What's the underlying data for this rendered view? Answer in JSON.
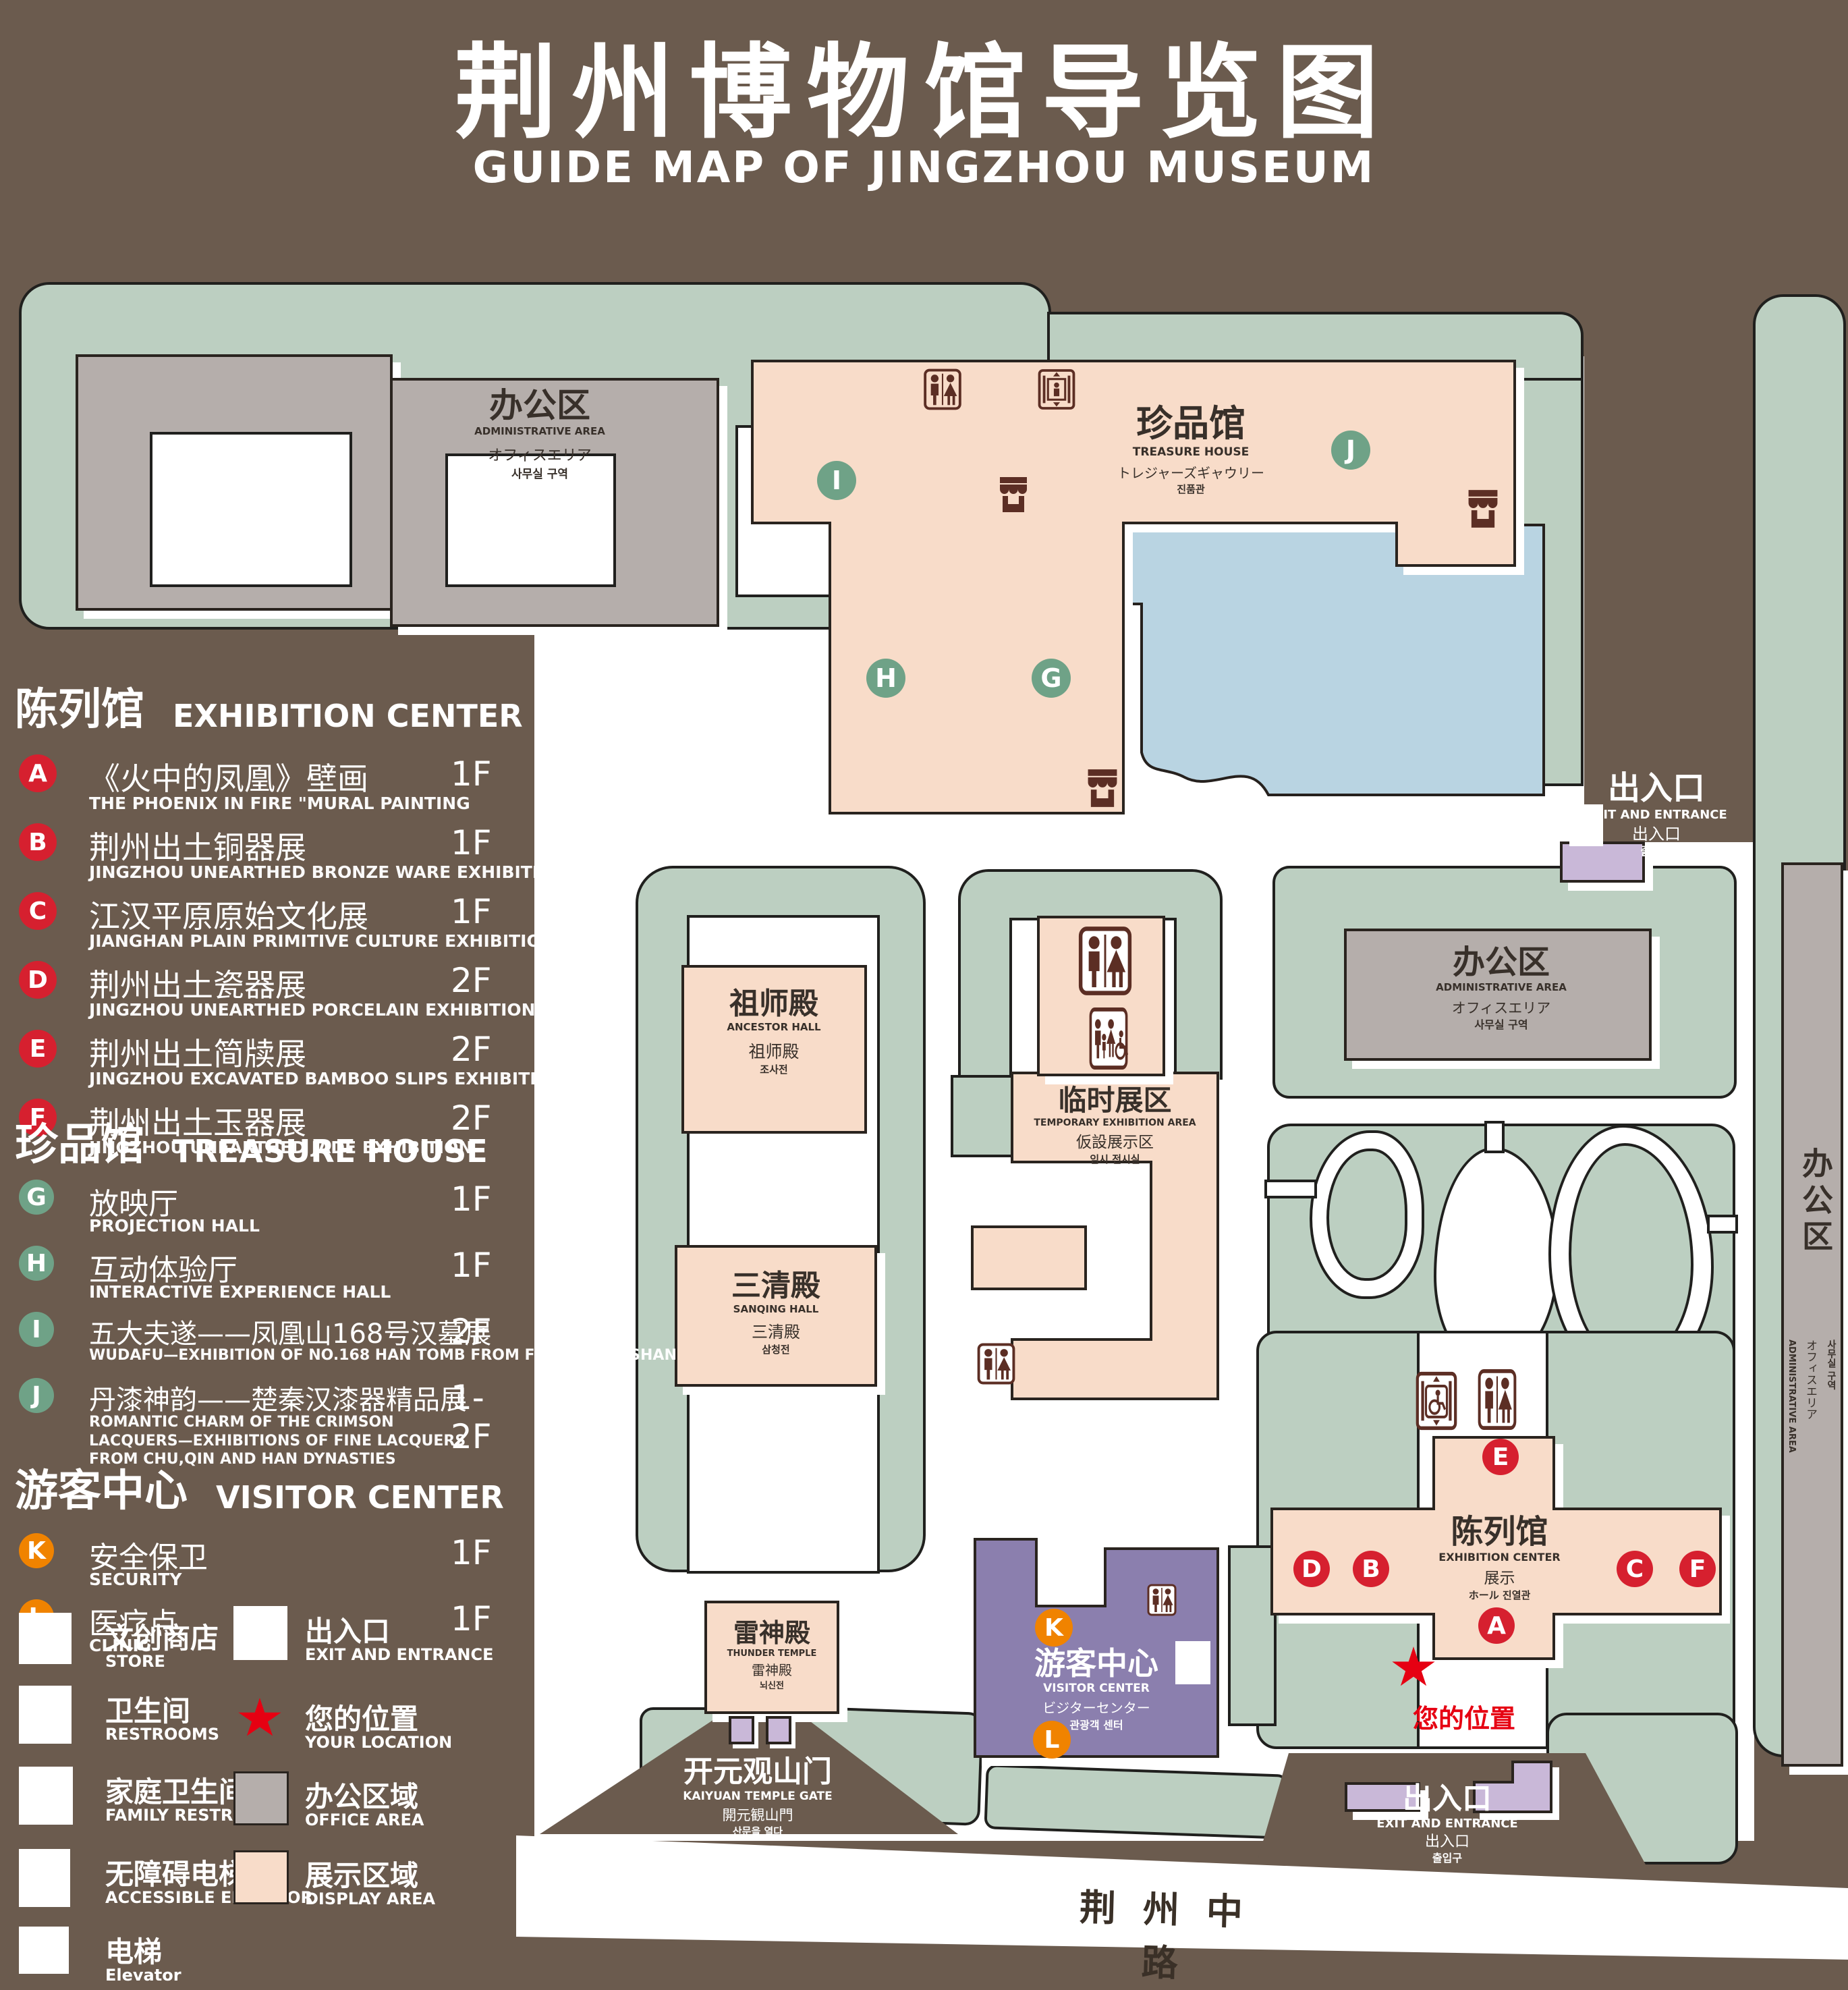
{
  "title": {
    "zh": "荆州博物馆导览图",
    "en": "GUIDE MAP OF JINGZHOU MUSEUM"
  },
  "legend": {
    "sections": [
      {
        "zh": "陈列馆",
        "en": "EXHIBITION CENTER",
        "items": [
          {
            "letter": "A",
            "zh": "《火中的凤凰》壁画",
            "en": "THE PHOENIX IN FIRE \"MURAL PAINTING",
            "floor": "1F"
          },
          {
            "letter": "B",
            "zh": "荆州出土铜器展",
            "en": "JINGZHOU UNEARTHED BRONZE WARE EXHIBITION",
            "floor": "1F"
          },
          {
            "letter": "C",
            "zh": "江汉平原原始文化展",
            "en": "JIANGHAN PLAIN PRIMITIVE CULTURE EXHIBITION",
            "floor": "1F"
          },
          {
            "letter": "D",
            "zh": "荆州出土瓷器展",
            "en": "JINGZHOU UNEARTHED PORCELAIN EXHIBITIONE",
            "floor": "2F"
          },
          {
            "letter": "E",
            "zh": "荆州出土简牍展",
            "en": "JINGZHOU EXCAVATED BAMBOO SLIPS EXHIBITION",
            "floor": "2F"
          },
          {
            "letter": "F",
            "zh": "荆州出土玉器展",
            "en": "JINGZHOU UNEARTHED JADE EXHIBITION",
            "floor": "2F"
          }
        ]
      },
      {
        "zh": "珍品馆",
        "en": "TREASURE HOUSE",
        "items": [
          {
            "letter": "G",
            "zh": "放映厅",
            "en": "PROJECTION HALL",
            "floor": "1F"
          },
          {
            "letter": "H",
            "zh": "互动体验厅",
            "en": "INTERACTIVE EXPERIENCE HALL",
            "floor": "1F"
          },
          {
            "letter": "I",
            "zh": "五大夫遂——凤凰山168号汉墓展",
            "en": "WUDAFU—EXHIBITION OF NO.168 HAN TOMB FROM FENGHUANGSHAN",
            "floor": "2F"
          },
          {
            "letter": "J",
            "zh": "丹漆神韵——楚秦汉漆器精品展",
            "en": "ROMANTIC CHARM OF THE CRIMSON LACQUERS—EXHIBITIONS OF FINE LACQUERS FROM CHU,QIN AND HAN DYNASTIES",
            "floor": "1-2F"
          }
        ]
      },
      {
        "zh": "游客中心",
        "en": "VISITOR CENTER",
        "items": [
          {
            "letter": "K",
            "zh": "安全保卫",
            "en": "SECURITY",
            "floor": "1F"
          },
          {
            "letter": "L",
            "zh": "医疗点",
            "en": "CLINIC",
            "floor": "1F"
          }
        ]
      }
    ],
    "symbols_left": [
      {
        "icon": "store-icon",
        "zh": "文创商店",
        "en": "STORE"
      },
      {
        "icon": "restroom-icon",
        "zh": "卫生间",
        "en": "RESTROOMS"
      },
      {
        "icon": "family-restroom-icon",
        "zh": "家庭卫生间",
        "en": "FAMILY RESTROOMS"
      },
      {
        "icon": "accessible-elevator-icon",
        "zh": "无障碍电梯",
        "en": "ACCESSIBLE ELEVATOR"
      },
      {
        "icon": "elevator-icon",
        "zh": "电梯",
        "en": "Elevator"
      }
    ],
    "symbols_right": [
      {
        "icon": "exit-icon",
        "zh": "出入口",
        "en": "EXIT AND ENTRANCE"
      },
      {
        "icon": "location-star-icon",
        "zh": "您的位置",
        "en": "YOUR LOCATION"
      },
      {
        "icon": "office-area-swatch",
        "zh": "办公区域",
        "en": "OFFICE AREA",
        "swatch": "#B5AEAB"
      },
      {
        "icon": "display-area-swatch",
        "zh": "展示区域",
        "en": "DISPLAY AREA",
        "swatch": "#F8DCC9"
      }
    ]
  },
  "map": {
    "admin_tl": {
      "zh": "办公区",
      "en": "ADMINISTRATIVE AREA",
      "jp": "オフィスエリア",
      "kr": "사무실 구역"
    },
    "treasure": {
      "zh": "珍品馆",
      "en": "TREASURE HOUSE",
      "jp": "トレジャーズギャウリー",
      "kr": "진품관"
    },
    "ancestor": {
      "zh": "祖师殿",
      "en": "ANCESTOR HALL",
      "jp": "祖师殿",
      "kr": "조사전"
    },
    "temp": {
      "zh": "临时展区",
      "en": "TEMPORARY EXHIBITION AREA",
      "jp": "仮設展示区",
      "kr": "임시 전시실"
    },
    "admin_mid": {
      "zh": "办公区",
      "en": "ADMINISTRATIVE AREA",
      "jp": "オフィスエリア",
      "kr": "사무실 구역"
    },
    "admin_strip": {
      "zh": "办公区",
      "en": "ADMINISTRATIVE AREA",
      "jp": "オフィスエリア",
      "kr": "사무실 구역"
    },
    "sanqing": {
      "zh": "三清殿",
      "en": "SANQING HALL",
      "jp": "三清殿",
      "kr": "삼청전"
    },
    "thunder": {
      "zh": "雷神殿",
      "en": "THUNDER TEMPLE",
      "jp": "雷神殿",
      "kr": "뇌신전"
    },
    "visitor": {
      "zh": "游客中心",
      "en": "VISITOR CENTER",
      "jp": "ビジターセンター",
      "kr": "관광객 센터"
    },
    "exhibition": {
      "zh": "陈列馆",
      "en": "EXHIBITION CENTER",
      "jp": "展示",
      "jpkr": "ホール 진열관"
    },
    "exit_tr": {
      "zh": "出入口",
      "en": "EXIT AND ENTRANCE",
      "jp": "出入口",
      "kr": "출입구"
    },
    "exit_br": {
      "zh": "出入口",
      "en": "EXIT AND ENTRANCE",
      "jp": "出入口",
      "kr": "출입구"
    },
    "gate": {
      "zh": "开元观山门",
      "en": "KAIYUAN TEMPLE GATE",
      "jp": "開元観山門",
      "kr": "산문을 열다"
    },
    "road": {
      "name": "荆州中路"
    },
    "your_location": "您的位置",
    "markers": {
      "A": "A",
      "B": "B",
      "C": "C",
      "D": "D",
      "E": "E",
      "F": "F",
      "G": "G",
      "H": "H",
      "I": "I",
      "J": "J",
      "K": "K",
      "L": "L"
    }
  },
  "colors": {
    "background": "#6B5B4E",
    "lawn": "#BCCFC1",
    "display_area": "#F8DCC9",
    "office_area": "#B5AEAB",
    "lake": "#B9D4E2",
    "visitor_center": "#8B7FAE",
    "gate_building": "#C9B8D8",
    "marker_exhibition": "#D6202F",
    "marker_treasure": "#6FA287",
    "marker_visitor": "#F08300",
    "location_star": "#E60012",
    "icon": "#5C2E24"
  }
}
